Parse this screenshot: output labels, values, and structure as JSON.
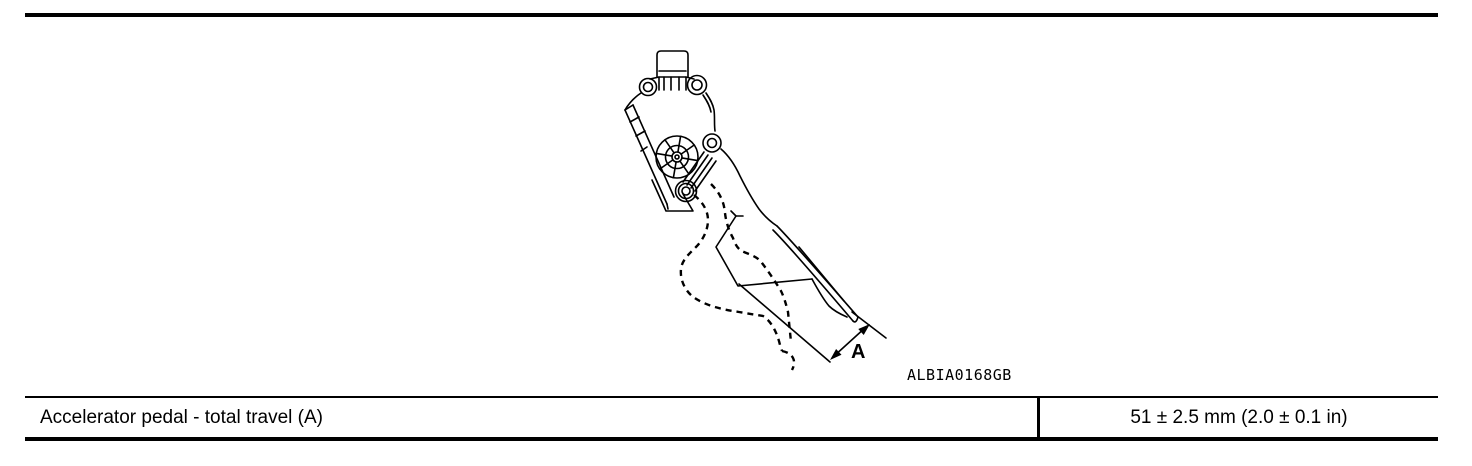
{
  "colors": {
    "ink": "#000000",
    "background": "#ffffff"
  },
  "figure": {
    "code": "ALBIA0168GB",
    "dimension_label": "A"
  },
  "spec_table": {
    "rows": [
      {
        "label": "Accelerator pedal - total travel (A)",
        "value": "51 ± 2.5 mm (2.0 ± 0.1 in)"
      }
    ]
  }
}
